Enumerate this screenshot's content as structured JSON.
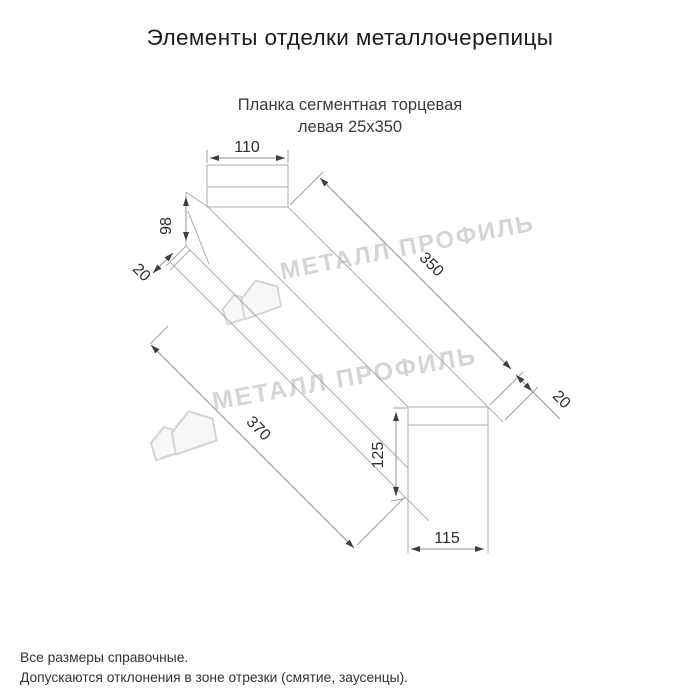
{
  "page": {
    "title": "Элементы отделки металлочерепицы"
  },
  "drawing": {
    "subtitle_line1": "Планка сегментная торцевая",
    "subtitle_line2": "левая 25x350",
    "dims": {
      "top_width": "110",
      "left_face": "98",
      "left_hem": "20",
      "length_top": "350",
      "right_hem": "20",
      "length_bottom": "370",
      "right_face": "125",
      "bottom_width": "115"
    },
    "watermark_text": "МЕТАЛЛ ПРОФИЛЬ"
  },
  "footer": {
    "line1": "Все размеры справочные.",
    "line2": "Допускаются отклонения в зоне отрезки (смятие, заусенцы)."
  }
}
